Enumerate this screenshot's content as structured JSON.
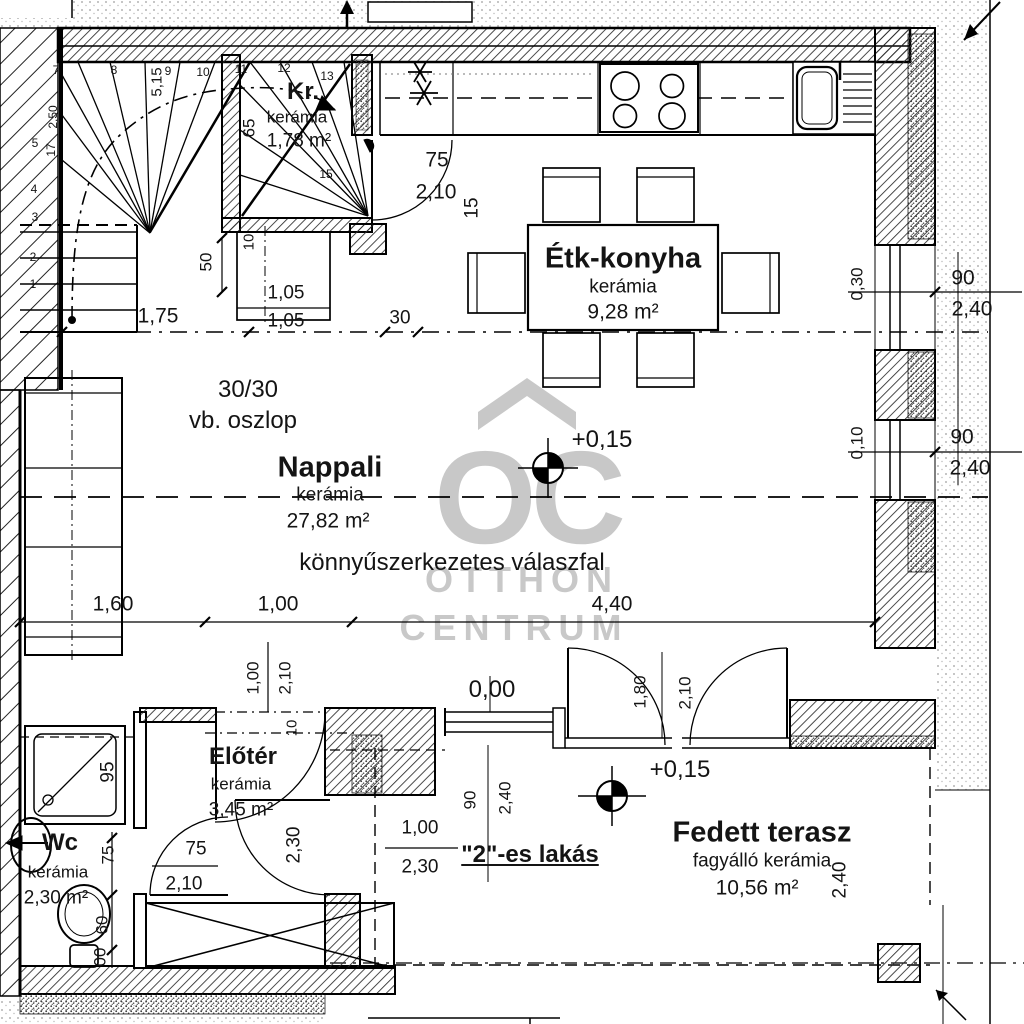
{
  "watermark": {
    "logo": "OC",
    "line1": "OTTHON",
    "line2": "CENTRUM"
  },
  "rooms": {
    "kr": {
      "name": "Kr.",
      "material": "kerámia",
      "area": "1,78 m²"
    },
    "konyha": {
      "name": "Étk-konyha",
      "material": "kerámia",
      "area": "9,28 m²"
    },
    "nappali": {
      "name": "Nappali",
      "material": "kerámia",
      "area": "27,82 m²"
    },
    "eloter": {
      "name": "Előtér",
      "material": "kerámia",
      "area": "3,45 m²"
    },
    "wc": {
      "name": "Wc",
      "material": "kerámia",
      "area": "2,30 m²"
    },
    "terasz": {
      "name": "Fedett terasz",
      "material": "fagyálló kerámia",
      "area": "10,56 m²"
    }
  },
  "notes": {
    "column1": "30/30",
    "column2": "vb. oszlop",
    "partition": "könnyűszerkezetes válaszfal",
    "unit": "\"2\"-es lakás",
    "level1": "+0,15",
    "level2": "+0,15",
    "level0": "0,00"
  },
  "dims": {
    "kr_door_w": "75",
    "kr_door_h": "2,10",
    "wall15": "15",
    "kr65": "65",
    "stair515": "5,15",
    "d50": "50",
    "d10a": "10",
    "box_w": "1,05",
    "box_w2": "1,05",
    "d175": "1,75",
    "d30": "30",
    "win1_off": "0,30",
    "win1_w": "90",
    "win1_h": "2,40",
    "win2_off": "0,10",
    "win2_w": "90",
    "win2_h": "2,40",
    "d160": "1,60",
    "d100": "1,00",
    "d440": "4,40",
    "entry_w": "1,00",
    "entry_h": "2,10",
    "d10b": "10",
    "eloter_door_h": "2,30",
    "wc_door_w": "75",
    "wc_door_h": "2,10",
    "shower": "95",
    "d75": "75",
    "d60": "60",
    "d00": "00",
    "win3_w": "90",
    "win3_h": "2,40",
    "open_w": "1,00",
    "open_h": "2,30",
    "fr_w": "1,80",
    "fr_h": "2,10",
    "terr_h": "2,40"
  },
  "stairs": {
    "s1": "1",
    "s2": "2",
    "s3": "3",
    "s4": "4",
    "s5": "5",
    "s7": "7",
    "s8": "8",
    "s9": "9",
    "s10": "10",
    "s11": "11",
    "s12": "12",
    "s13": "13",
    "s15": "15",
    "note17": "17",
    "note250": "2,50"
  }
}
